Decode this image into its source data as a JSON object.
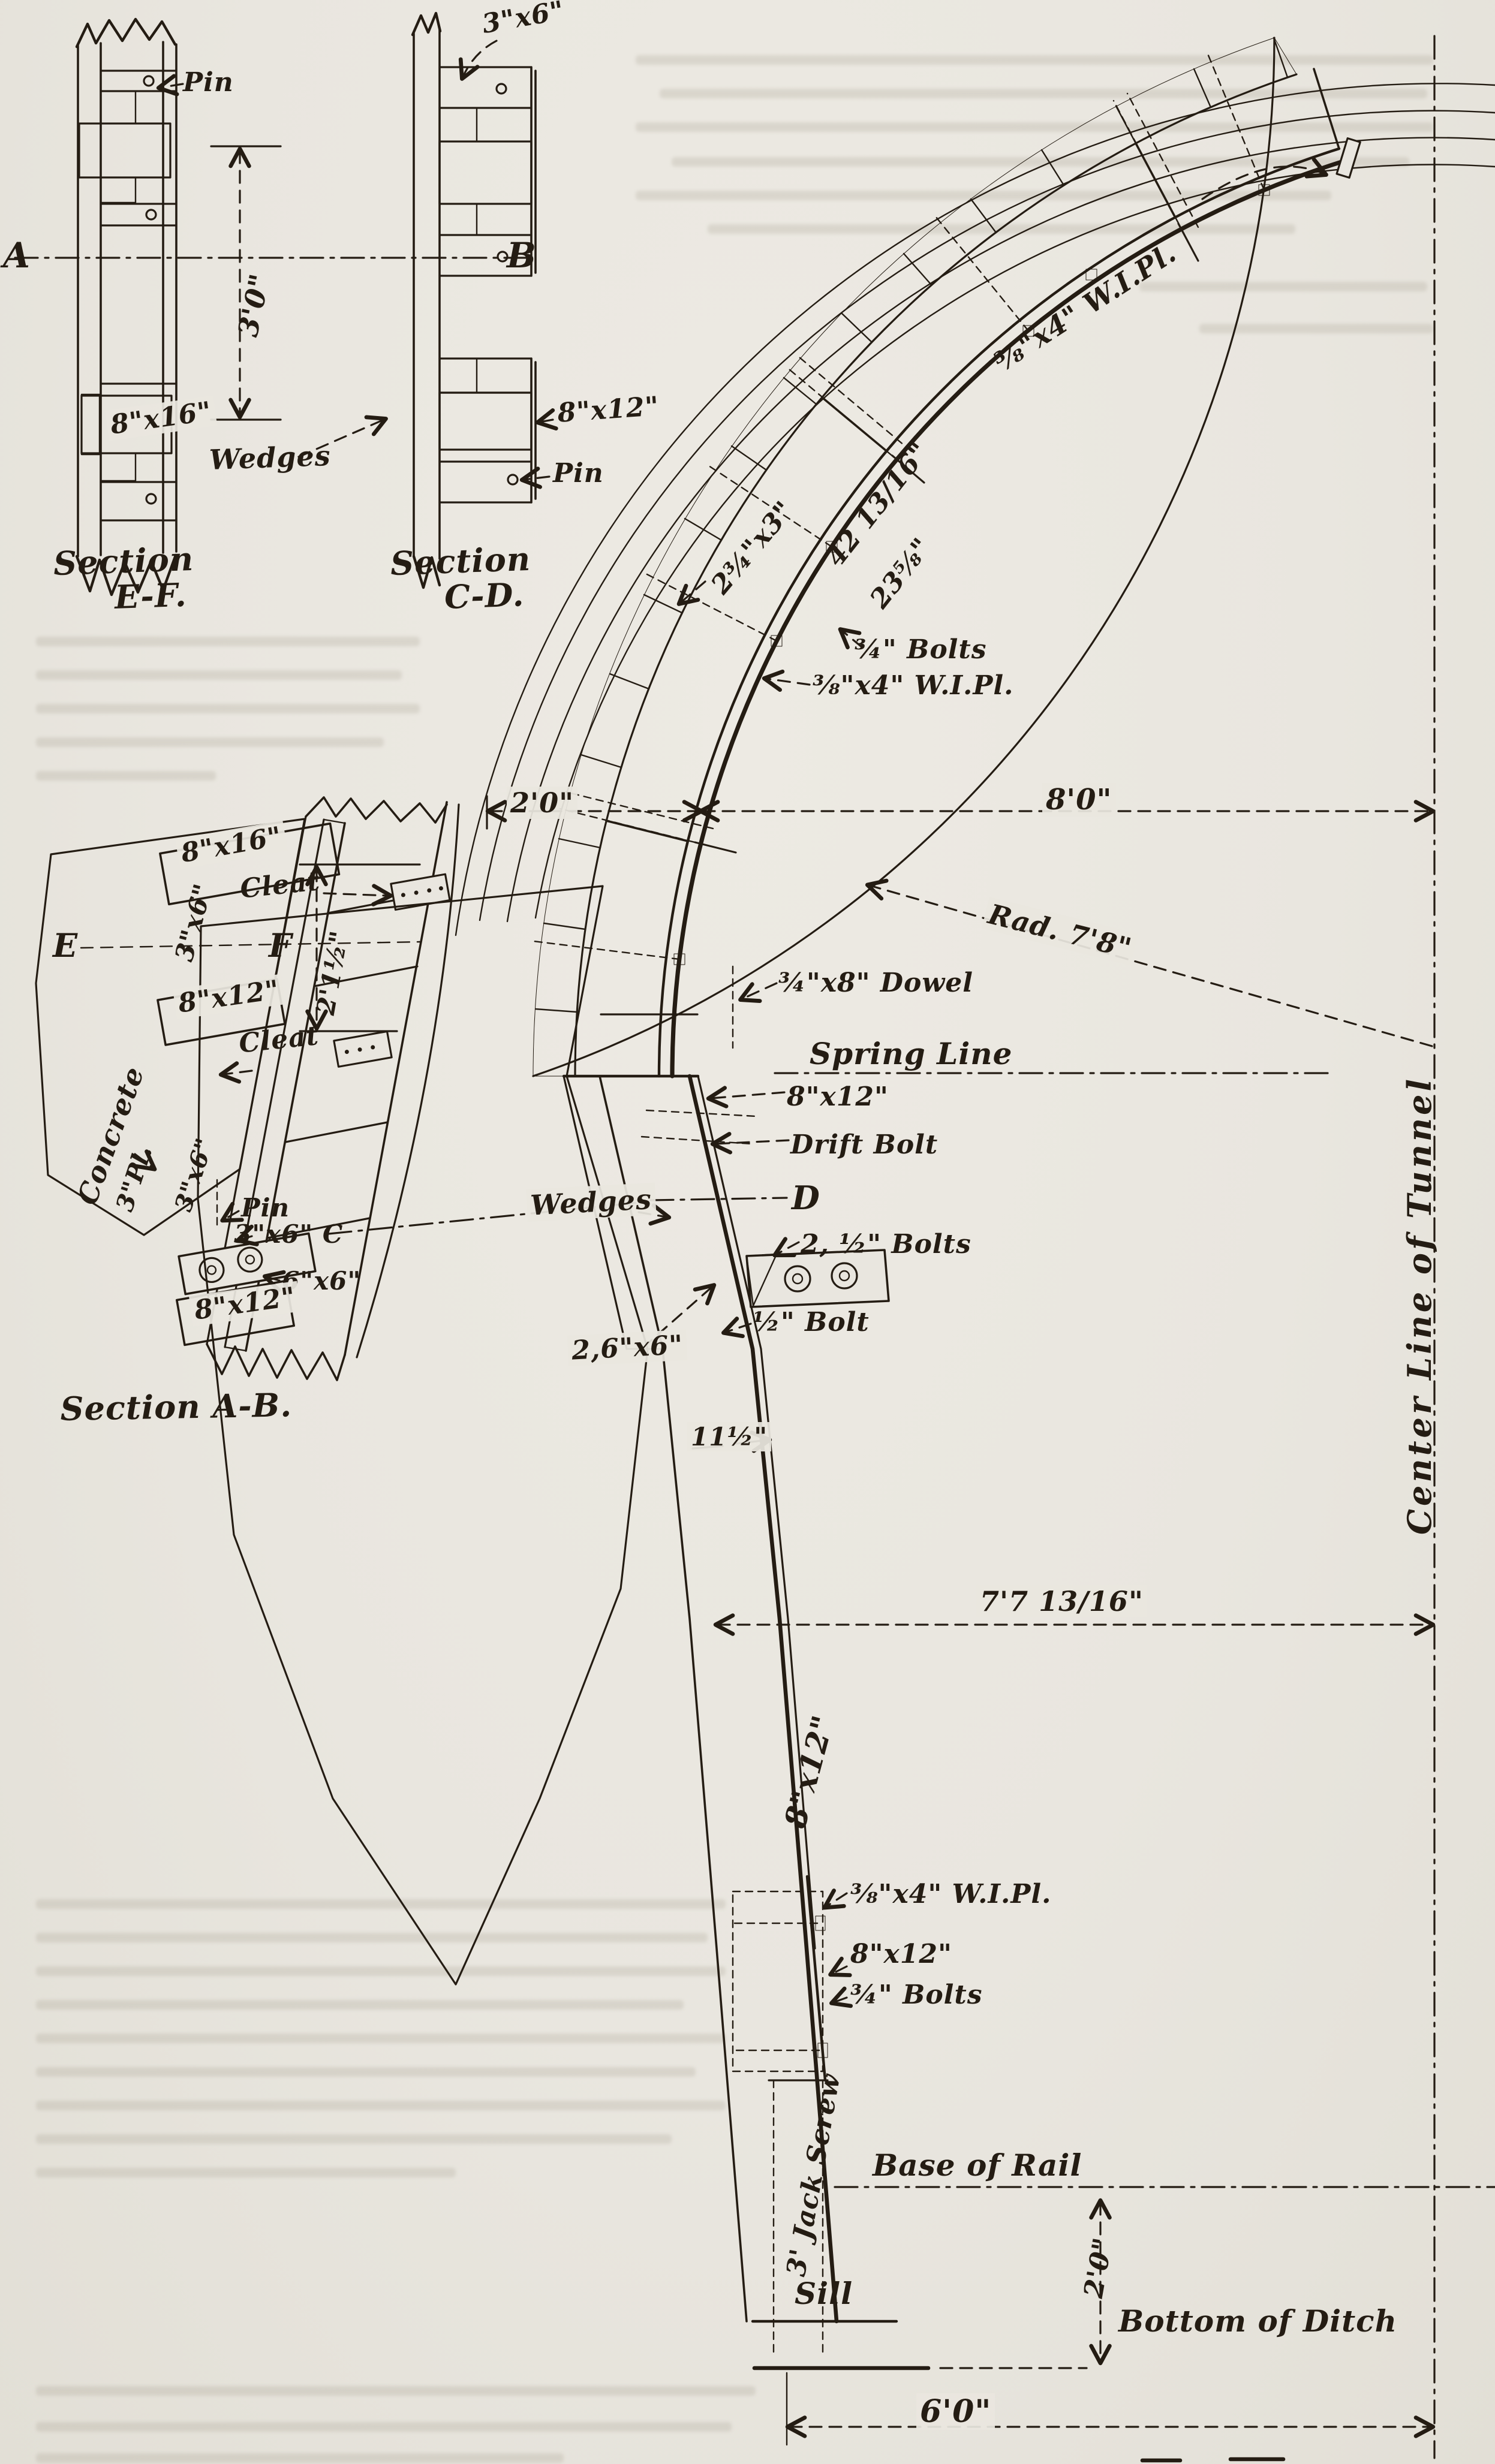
{
  "colors": {
    "paper": "#e9e6df",
    "ink": "#241c13"
  },
  "figure": {
    "ef": {
      "pin": "Pin",
      "dim": "3'0\"",
      "timber": "8\"x16\"",
      "wedges": "Wedges",
      "cap1": "Section",
      "cap2": "E-F.",
      "datum_a": "A",
      "datum_b": "B"
    },
    "cd": {
      "lagging": "3\"x6\"",
      "timber": "8\"x12\"",
      "pin": "Pin",
      "cap1": "Section",
      "cap2": "C-D."
    },
    "ab": {
      "timber_top": "8\"x16\"",
      "cleat_top": "Cleat",
      "point_e": "E",
      "point_f": "F",
      "dim": "2'1½\"",
      "lagging_top": "3\"x6\"",
      "timber_mid": "8\"x12\"",
      "cleat_bottom": "Cleat",
      "concrete": "Concrete",
      "plate": "3\"Pl.",
      "lagging_bottom": "3\"x6\"",
      "pin": "Pin",
      "brace": "3\"x6\" C",
      "block": "6\"x6\"",
      "timber_bottom": "8\"x12\"",
      "caption": "Section A-B."
    },
    "main": {
      "plate_top": "⅜\"x4\" W.I.Pl.",
      "lagging": "2¾\"x3\"",
      "seg_long": "42 13/16\"",
      "seg_short": "23⅝\"",
      "bolts_arc": "¾\" Bolts",
      "plate_mid": "⅜\"x4\" W.I.Pl.",
      "dim_timbering": "2'0\"",
      "dim_halfspan": "8'0\"",
      "radius": "Rad. 7'8\"",
      "dowel": "¾\"x8\" Dowel",
      "spring_line": "Spring Line",
      "wall_post": "8\"x12\"",
      "drift_bolt": "Drift Bolt",
      "point_d": "D",
      "bolts_two": "2, ½\" Bolts",
      "bolt_half": "½\" Bolt",
      "wedges": "Wedges",
      "blocks": "2,6\"x6\"",
      "dim_offset": "11½\"",
      "dim_lower": "7'7 13/16\"",
      "post": "8\"x12\"",
      "plate_bottom": "⅜\"x4\" W.I.Pl.",
      "block_bottom": "8\"x12\"",
      "bolts_bottom": "¾\" Bolts",
      "jack_screw": "3' Jack Screw",
      "base_of_rail": "Base of Rail",
      "sill": "Sill",
      "dim_rail_ditch": "2'0\"",
      "bottom_of_ditch": "Bottom of Ditch",
      "dim_ditch": "6'0\"",
      "center_line": "Center Line of Tunnel"
    }
  }
}
